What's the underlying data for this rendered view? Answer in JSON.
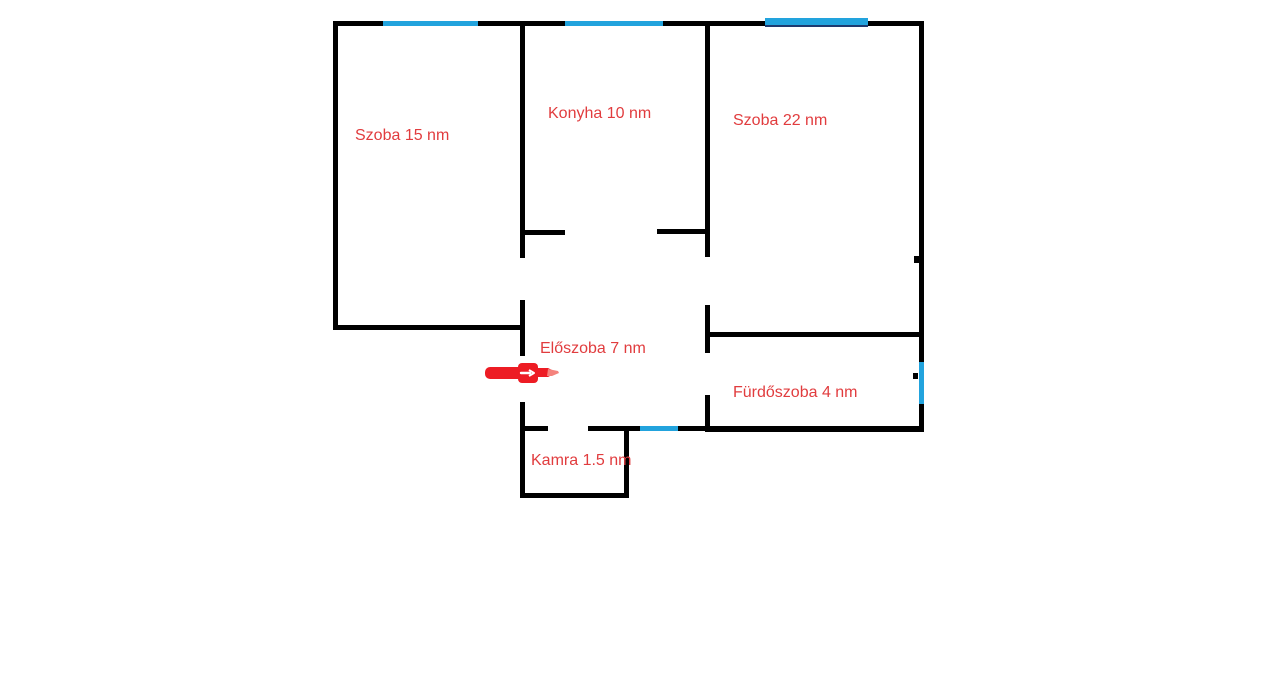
{
  "floorplan": {
    "type": "apartment-floor-plan",
    "unit_suffix": "nm"
  },
  "rooms": [
    {
      "id": "szoba-15",
      "label": "Szoba 15 nm",
      "area_nm": 15
    },
    {
      "id": "konyha",
      "label": "Konyha 10 nm",
      "area_nm": 10
    },
    {
      "id": "szoba-22",
      "label": "Szoba 22 nm",
      "area_nm": 22
    },
    {
      "id": "eloszoba",
      "label": "Előszoba 7 nm",
      "area_nm": 7
    },
    {
      "id": "furdoszoba",
      "label": "Fürdőszoba 4 nm",
      "area_nm": 4
    },
    {
      "id": "kamra",
      "label": "Kamra 1.5 nm",
      "area_nm": 1.5
    }
  ],
  "colors": {
    "wall": "#000000",
    "window": "#22a3dd",
    "window_shade": "#1e3a70",
    "label": "#e13c3e",
    "arrow": "#ed1c24",
    "arrow_tip": "#f4837d",
    "background": "#ffffff"
  }
}
